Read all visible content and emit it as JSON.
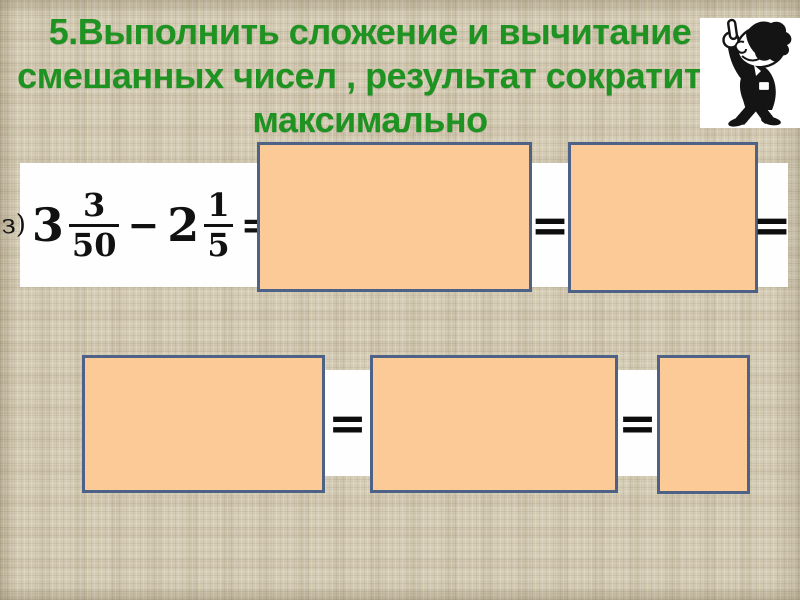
{
  "title": {
    "line1": "5.Выполнить сложение и вычитание",
    "line2": "смешанных чисел , результат сократить",
    "line3": "максимально"
  },
  "expression": {
    "item_label": "з)",
    "whole_1": "3",
    "fraction_1": {
      "numerator": "3",
      "denominator": "50"
    },
    "minus": "−",
    "whole_2": "2",
    "fraction_2": {
      "numerator": "1",
      "denominator": "5"
    },
    "equals": "="
  },
  "row1": {
    "equals_1": "=",
    "equals_2": "="
  },
  "row2": {
    "equals_1": "=",
    "equals_2": "="
  },
  "clipart": {
    "icon": "pointing-man"
  },
  "colors": {
    "background": "#d5ccb5",
    "title_green": "#1e9321",
    "box_fill": "#fcca97",
    "box_border": "#4e6186",
    "strip_white": "#fefefe",
    "text_black": "#111111"
  }
}
